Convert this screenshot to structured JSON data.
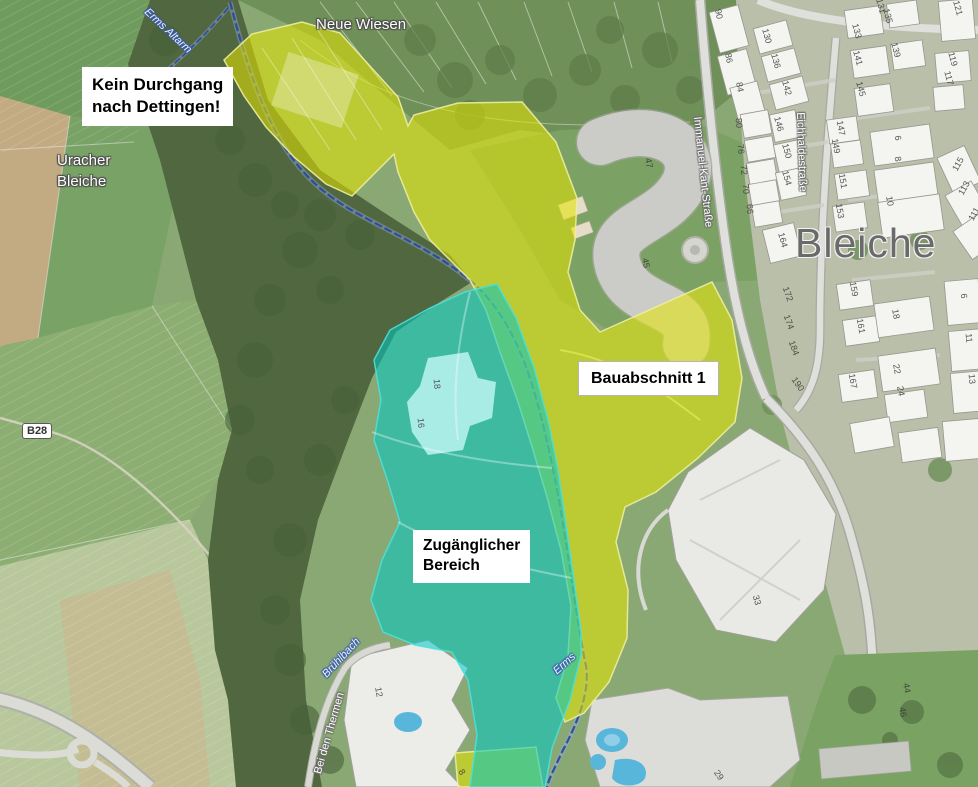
{
  "map": {
    "callouts": {
      "no_passage": {
        "line1": "Kein Durchgang",
        "line2": "nach Dettingen!"
      },
      "construction": {
        "label": "Bauabschnitt 1"
      },
      "accessible": {
        "line1": "Zugänglicher",
        "line2": "Bereich"
      }
    },
    "road_badge": "B28",
    "labels": [
      {
        "text": "Neue Wiesen",
        "x": 316,
        "y": 16,
        "style": "place",
        "rot": 0
      },
      {
        "text": "Uracher",
        "x": 57,
        "y": 152,
        "style": "place",
        "rot": 0
      },
      {
        "text": "Bleiche",
        "x": 57,
        "y": 173,
        "style": "place",
        "rot": 0
      },
      {
        "text": "Bleiche",
        "x": 795,
        "y": 220,
        "style": "district",
        "rot": 0
      },
      {
        "text": "Immanuel-Kant-Straße",
        "x": 703,
        "y": 116,
        "style": "street",
        "rot": 84
      },
      {
        "text": "Eichhaldestraße",
        "x": 806,
        "y": 112,
        "style": "street",
        "rot": 88
      },
      {
        "text": "Bei den Thermen",
        "x": 312,
        "y": 772,
        "style": "street",
        "rot": -74
      },
      {
        "text": "Erms Altarm",
        "x": 150,
        "y": 6,
        "style": "water",
        "rot": 43
      },
      {
        "text": "Brühlbach",
        "x": 320,
        "y": 672,
        "style": "water",
        "rot": -47
      },
      {
        "text": "Erms",
        "x": 551,
        "y": 668,
        "style": "water",
        "rot": -42
      }
    ],
    "house_numbers": [
      {
        "t": "90",
        "x": 719,
        "y": 14,
        "r": 80
      },
      {
        "t": "86",
        "x": 729,
        "y": 58,
        "r": 80
      },
      {
        "t": "84",
        "x": 740,
        "y": 87,
        "r": 80
      },
      {
        "t": "130",
        "x": 767,
        "y": 36,
        "r": 75
      },
      {
        "t": "136",
        "x": 776,
        "y": 61,
        "r": 75
      },
      {
        "t": "142",
        "x": 787,
        "y": 88,
        "r": 75
      },
      {
        "t": "80",
        "x": 739,
        "y": 123,
        "r": 85
      },
      {
        "t": "76",
        "x": 741,
        "y": 149,
        "r": 85
      },
      {
        "t": "72",
        "x": 744,
        "y": 170,
        "r": 85
      },
      {
        "t": "70",
        "x": 746,
        "y": 189,
        "r": 85
      },
      {
        "t": "66",
        "x": 750,
        "y": 209,
        "r": 85
      },
      {
        "t": "146",
        "x": 779,
        "y": 124,
        "r": 75
      },
      {
        "t": "150",
        "x": 787,
        "y": 151,
        "r": 75
      },
      {
        "t": "154",
        "x": 787,
        "y": 178,
        "r": 75
      },
      {
        "t": "164",
        "x": 783,
        "y": 240,
        "r": 75
      },
      {
        "t": "172",
        "x": 788,
        "y": 294,
        "r": 70
      },
      {
        "t": "174",
        "x": 789,
        "y": 322,
        "r": 70
      },
      {
        "t": "184",
        "x": 794,
        "y": 348,
        "r": 70
      },
      {
        "t": "190",
        "x": 798,
        "y": 384,
        "r": 55
      },
      {
        "t": "131",
        "x": 881,
        "y": 6,
        "r": 75
      },
      {
        "t": "135",
        "x": 888,
        "y": 16,
        "r": 75
      },
      {
        "t": "133",
        "x": 857,
        "y": 31,
        "r": 75
      },
      {
        "t": "139",
        "x": 896,
        "y": 50,
        "r": 75
      },
      {
        "t": "141",
        "x": 858,
        "y": 58,
        "r": 75
      },
      {
        "t": "145",
        "x": 861,
        "y": 89,
        "r": 75
      },
      {
        "t": "121",
        "x": 958,
        "y": 8,
        "r": 75
      },
      {
        "t": "119",
        "x": 953,
        "y": 59,
        "r": 75
      },
      {
        "t": "117",
        "x": 949,
        "y": 78,
        "r": 75
      },
      {
        "t": "147",
        "x": 841,
        "y": 128,
        "r": 80
      },
      {
        "t": "149",
        "x": 836,
        "y": 146,
        "r": 80
      },
      {
        "t": "151",
        "x": 843,
        "y": 181,
        "r": 80
      },
      {
        "t": "153",
        "x": 840,
        "y": 211,
        "r": 80
      },
      {
        "t": "6",
        "x": 898,
        "y": 138,
        "r": 80
      },
      {
        "t": "8",
        "x": 898,
        "y": 159,
        "r": 80
      },
      {
        "t": "10",
        "x": 890,
        "y": 201,
        "r": 80
      },
      {
        "t": "115",
        "x": 958,
        "y": 164,
        "r": -60
      },
      {
        "t": "113",
        "x": 964,
        "y": 188,
        "r": -60
      },
      {
        "t": "111",
        "x": 974,
        "y": 214,
        "r": -60
      },
      {
        "t": "159",
        "x": 854,
        "y": 289,
        "r": 80
      },
      {
        "t": "161",
        "x": 861,
        "y": 326,
        "r": 80
      },
      {
        "t": "167",
        "x": 853,
        "y": 381,
        "r": 80
      },
      {
        "t": "18",
        "x": 896,
        "y": 314,
        "r": 80
      },
      {
        "t": "22",
        "x": 897,
        "y": 369,
        "r": 80
      },
      {
        "t": "24",
        "x": 901,
        "y": 391,
        "r": 80
      },
      {
        "t": "6",
        "x": 964,
        "y": 296,
        "r": 85
      },
      {
        "t": "11",
        "x": 969,
        "y": 338,
        "r": 85
      },
      {
        "t": "13",
        "x": 972,
        "y": 379,
        "r": 85
      },
      {
        "t": "47",
        "x": 649,
        "y": 163,
        "r": 80
      },
      {
        "t": "45",
        "x": 646,
        "y": 263,
        "r": 80
      },
      {
        "t": "18",
        "x": 437,
        "y": 384,
        "r": 85
      },
      {
        "t": "16",
        "x": 421,
        "y": 423,
        "r": 85
      },
      {
        "t": "12",
        "x": 379,
        "y": 692,
        "r": 80
      },
      {
        "t": "29",
        "x": 719,
        "y": 775,
        "r": 55
      },
      {
        "t": "33",
        "x": 757,
        "y": 600,
        "r": 75
      },
      {
        "t": "44",
        "x": 907,
        "y": 688,
        "r": 80
      },
      {
        "t": "46",
        "x": 903,
        "y": 712,
        "r": 80
      },
      {
        "t": "8",
        "x": 462,
        "y": 772,
        "r": 60
      }
    ],
    "colors": {
      "zone_yellow": "#e6e600",
      "zone_cyan": "#00c9c4",
      "zone_cyan_light": "#b2f0ea",
      "field_green": "#8aa873",
      "woodland_green": "#51673f",
      "road_gray": "#dcdcd6",
      "building_white": "#f4f4f1",
      "stream_blue": "#2d4a9b",
      "pool_blue": "#58b6da",
      "district_gray": "#6a6a6a"
    }
  }
}
